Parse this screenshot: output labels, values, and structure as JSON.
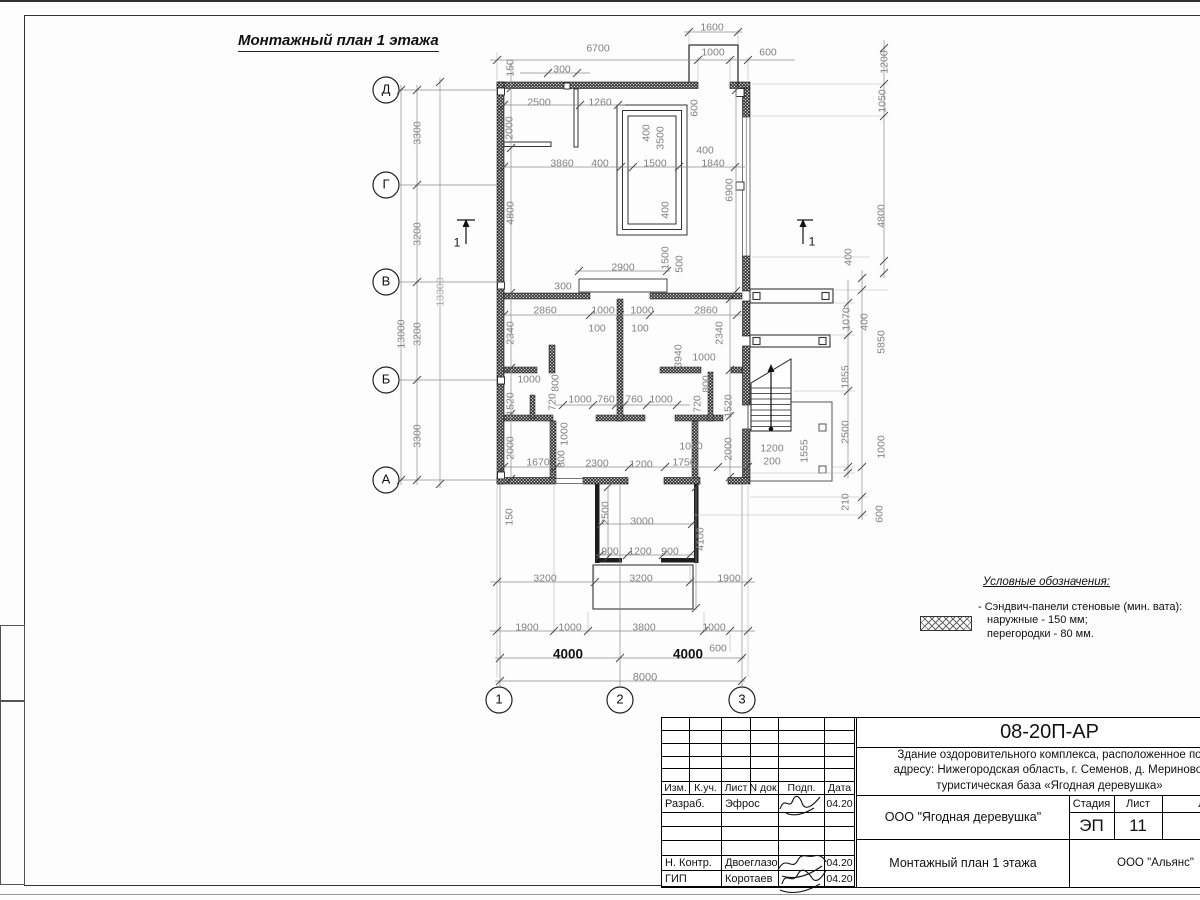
{
  "title": "Монтажный план 1 этажа",
  "legend": {
    "heading": "Условные обозначения:",
    "line1": "- Сэндвич-панели стеновые (мин. вата):",
    "line2": "наружные - 150 мм;",
    "line3": "перегородки - 80 мм."
  },
  "stamp": {
    "code": "08-20П-АР",
    "desc1": "Здание оздоровительного комплекса, расположенное по",
    "desc2": "адресу: Нижегородская область, г. Семенов, д. Мериново,",
    "desc3": "туристическая база «Ягодная деревушка»",
    "col_izm": "Изм.",
    "col_kuch": "К.уч.",
    "col_list": "Лист",
    "col_ndok": "N док.",
    "col_podp": "Подп.",
    "col_data": "Дата",
    "row1_role": "Разраб.",
    "row1_name": "Эфрос",
    "row1_date": "04.20",
    "row2_role": "Н. Контр.",
    "row2_name": "Двоеглазов",
    "row2_date": "04.20",
    "row3_role": "ГИП",
    "row3_name": "Коротаев",
    "row3_date": "04.20",
    "org": "ООО \"Ягодная деревушка\"",
    "stage_label": "Стадия",
    "sheet_label": "Лист",
    "sheets_label": "Листов",
    "stage": "ЭП",
    "sheet": "11",
    "sheets": "",
    "doc_title": "Монтажный план 1 этажа",
    "firm": "ООО \"Альянс\""
  },
  "plan": {
    "labels": [
      {
        "t": "1600",
        "x": 712,
        "y": 27
      },
      {
        "t": "6700",
        "x": 598,
        "y": 48
      },
      {
        "t": "1000",
        "x": 713,
        "y": 52
      },
      {
        "t": "600",
        "x": 768,
        "y": 52
      },
      {
        "t": "300",
        "x": 562,
        "y": 69
      },
      {
        "t": "150",
        "x": 510,
        "y": 68,
        "r": 1
      },
      {
        "t": "2500",
        "x": 539,
        "y": 102
      },
      {
        "t": "1260",
        "x": 600,
        "y": 102
      },
      {
        "t": "2000",
        "x": 509,
        "y": 128,
        "r": 1
      },
      {
        "t": "600",
        "x": 694,
        "y": 108,
        "r": 1
      },
      {
        "t": "400",
        "x": 646,
        "y": 133,
        "r": 1
      },
      {
        "t": "3500",
        "x": 660,
        "y": 138,
        "r": 1
      },
      {
        "t": "3860",
        "x": 562,
        "y": 163
      },
      {
        "t": "400",
        "x": 600,
        "y": 163
      },
      {
        "t": "1500",
        "x": 655,
        "y": 163
      },
      {
        "t": "400",
        "x": 705,
        "y": 150
      },
      {
        "t": "1840",
        "x": 713,
        "y": 163
      },
      {
        "t": "6900",
        "x": 729,
        "y": 190,
        "r": 1
      },
      {
        "t": "4800",
        "x": 510,
        "y": 213,
        "r": 1
      },
      {
        "t": "400",
        "x": 665,
        "y": 210,
        "r": 1
      },
      {
        "t": "1500",
        "x": 665,
        "y": 258,
        "r": 1
      },
      {
        "t": "500",
        "x": 679,
        "y": 264,
        "r": 1
      },
      {
        "t": "2900",
        "x": 623,
        "y": 267
      },
      {
        "t": "300",
        "x": 563,
        "y": 286
      },
      {
        "t": "2860",
        "x": 545,
        "y": 310
      },
      {
        "t": "1000",
        "x": 603,
        "y": 310
      },
      {
        "t": "1000",
        "x": 642,
        "y": 310
      },
      {
        "t": "2860",
        "x": 706,
        "y": 310
      },
      {
        "t": "100",
        "x": 597,
        "y": 328
      },
      {
        "t": "100",
        "x": 640,
        "y": 328
      },
      {
        "t": "2340",
        "x": 510,
        "y": 333,
        "r": 1
      },
      {
        "t": "2340",
        "x": 719,
        "y": 333,
        "r": 1
      },
      {
        "t": "3940",
        "x": 678,
        "y": 356,
        "r": 1
      },
      {
        "t": "1000",
        "x": 704,
        "y": 357
      },
      {
        "t": "1000",
        "x": 529,
        "y": 379
      },
      {
        "t": "800",
        "x": 555,
        "y": 383,
        "r": 1
      },
      {
        "t": "720",
        "x": 552,
        "y": 402,
        "r": 1
      },
      {
        "t": "800",
        "x": 706,
        "y": 384,
        "r": 1
      },
      {
        "t": "720",
        "x": 697,
        "y": 404,
        "r": 1
      },
      {
        "t": "1520",
        "x": 510,
        "y": 404,
        "r": 1
      },
      {
        "t": "1520",
        "x": 728,
        "y": 406,
        "r": 1
      },
      {
        "t": "1000",
        "x": 580,
        "y": 399
      },
      {
        "t": "760",
        "x": 606,
        "y": 399
      },
      {
        "t": "760",
        "x": 634,
        "y": 399
      },
      {
        "t": "1000",
        "x": 661,
        "y": 399
      },
      {
        "t": "1000",
        "x": 564,
        "y": 434,
        "r": 1
      },
      {
        "t": "800",
        "x": 561,
        "y": 459,
        "r": 1
      },
      {
        "t": "2000",
        "x": 510,
        "y": 448,
        "r": 1
      },
      {
        "t": "1670",
        "x": 538,
        "y": 462
      },
      {
        "t": "2300",
        "x": 597,
        "y": 463
      },
      {
        "t": "1200",
        "x": 641,
        "y": 464
      },
      {
        "t": "1750",
        "x": 684,
        "y": 462
      },
      {
        "t": "1000",
        "x": 691,
        "y": 446
      },
      {
        "t": "2000",
        "x": 728,
        "y": 449,
        "r": 1
      },
      {
        "t": "1200",
        "x": 772,
        "y": 448
      },
      {
        "t": "200",
        "x": 772,
        "y": 461
      },
      {
        "t": "1555",
        "x": 804,
        "y": 451,
        "r": 1
      },
      {
        "t": "150",
        "x": 509,
        "y": 517,
        "r": 1
      },
      {
        "t": "2500",
        "x": 605,
        "y": 513,
        "r": 1
      },
      {
        "t": "3000",
        "x": 642,
        "y": 521
      },
      {
        "t": "4100",
        "x": 700,
        "y": 539,
        "r": 1
      },
      {
        "t": "900",
        "x": 610,
        "y": 551
      },
      {
        "t": "1200",
        "x": 640,
        "y": 551
      },
      {
        "t": "900",
        "x": 670,
        "y": 551
      },
      {
        "t": "3200",
        "x": 545,
        "y": 578
      },
      {
        "t": "3200",
        "x": 641,
        "y": 578
      },
      {
        "t": "1900",
        "x": 729,
        "y": 578
      },
      {
        "t": "1900",
        "x": 527,
        "y": 627
      },
      {
        "t": "1000",
        "x": 570,
        "y": 627
      },
      {
        "t": "3800",
        "x": 644,
        "y": 627
      },
      {
        "t": "1000",
        "x": 714,
        "y": 627
      },
      {
        "t": "600",
        "x": 718,
        "y": 648
      },
      {
        "t": "4000",
        "x": 568,
        "y": 655,
        "s": 13.5,
        "b": 1,
        "c": "#111111"
      },
      {
        "t": "4000",
        "x": 688,
        "y": 655,
        "s": 13.5,
        "b": 1,
        "c": "#111111"
      },
      {
        "t": "8000",
        "x": 645,
        "y": 677,
        "s": 11
      },
      {
        "t": "3300",
        "x": 417,
        "y": 133,
        "r": 1
      },
      {
        "t": "3200",
        "x": 417,
        "y": 234,
        "r": 1
      },
      {
        "t": "3200",
        "x": 417,
        "y": 334,
        "r": 1
      },
      {
        "t": "3300",
        "x": 417,
        "y": 436,
        "r": 1
      },
      {
        "t": "13000",
        "x": 401,
        "y": 334,
        "r": 1
      },
      {
        "t": "13300",
        "x": 440,
        "y": 292,
        "r": 1,
        "c": "#ababab"
      },
      {
        "t": "1070",
        "x": 846,
        "y": 319,
        "r": 1
      },
      {
        "t": "1855",
        "x": 845,
        "y": 377,
        "r": 1
      },
      {
        "t": "2500",
        "x": 845,
        "y": 432,
        "r": 1
      },
      {
        "t": "210",
        "x": 845,
        "y": 502,
        "r": 1
      },
      {
        "t": "400",
        "x": 848,
        "y": 257,
        "r": 1
      },
      {
        "t": "400",
        "x": 864,
        "y": 322,
        "r": 1
      },
      {
        "t": "5850",
        "x": 881,
        "y": 342,
        "r": 1
      },
      {
        "t": "1000",
        "x": 881,
        "y": 447,
        "r": 1
      },
      {
        "t": "600",
        "x": 879,
        "y": 514,
        "r": 1
      },
      {
        "t": "1200",
        "x": 884,
        "y": 62,
        "r": 1
      },
      {
        "t": "1050",
        "x": 882,
        "y": 101,
        "r": 1
      },
      {
        "t": "4800",
        "x": 881,
        "y": 216,
        "r": 1
      },
      {
        "t": "1",
        "x": 457,
        "y": 243,
        "s": 12,
        "c": "#111111"
      },
      {
        "t": "1",
        "x": 812,
        "y": 242,
        "s": 12,
        "c": "#111111"
      },
      {
        "t": "Д",
        "x": 386,
        "y": 90,
        "s": 13,
        "c": "#111111"
      },
      {
        "t": "Г",
        "x": 386,
        "y": 185,
        "s": 13,
        "c": "#111111"
      },
      {
        "t": "В",
        "x": 386,
        "y": 282,
        "s": 13,
        "c": "#111111"
      },
      {
        "t": "Б",
        "x": 386,
        "y": 380,
        "s": 13,
        "c": "#111111"
      },
      {
        "t": "А",
        "x": 386,
        "y": 480,
        "s": 13,
        "c": "#111111"
      },
      {
        "t": "1",
        "x": 499,
        "y": 700,
        "s": 13,
        "c": "#111111"
      },
      {
        "t": "2",
        "x": 620,
        "y": 700,
        "s": 13,
        "c": "#111111"
      },
      {
        "t": "3",
        "x": 742,
        "y": 700,
        "s": 13,
        "c": "#111111"
      }
    ]
  }
}
